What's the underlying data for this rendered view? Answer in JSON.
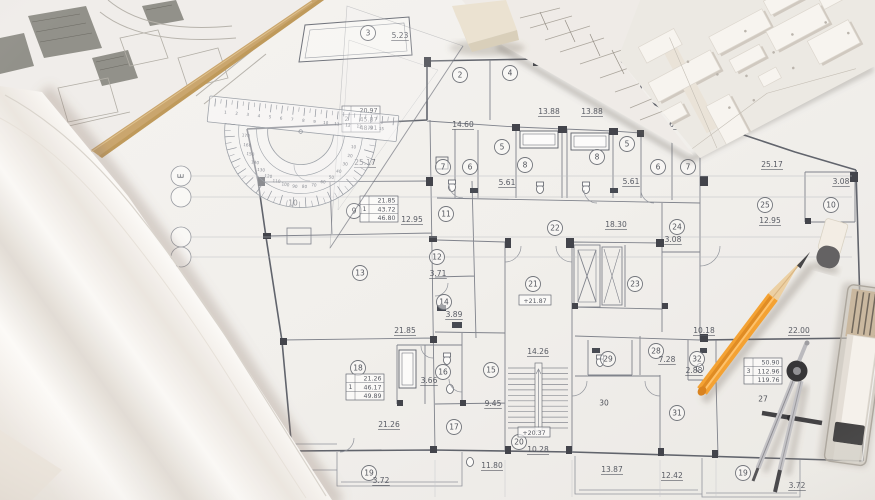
{
  "scene_title": "Architectural blueprint with drafting tools",
  "floor_plan": {
    "grid_bubbles": [
      {
        "label": "E",
        "x": 181,
        "y": 176
      },
      {
        "label": "",
        "x": 181,
        "y": 197
      },
      {
        "label": "",
        "x": 181,
        "y": 237
      },
      {
        "label": "",
        "x": 181,
        "y": 257
      }
    ],
    "rooms": [
      {
        "n": "3",
        "x": 368,
        "y": 33,
        "circled": true
      },
      {
        "n": "2",
        "x": 460,
        "y": 75,
        "circled": true
      },
      {
        "n": "4",
        "x": 510,
        "y": 73,
        "circled": true
      },
      {
        "n": "5",
        "x": 502,
        "y": 147,
        "circled": true
      },
      {
        "n": "7",
        "x": 443,
        "y": 167,
        "circled": true
      },
      {
        "n": "6",
        "x": 470,
        "y": 167,
        "circled": true
      },
      {
        "n": "8",
        "x": 525,
        "y": 165,
        "circled": true
      },
      {
        "n": "8",
        "x": 597,
        "y": 157,
        "circled": true
      },
      {
        "n": "5",
        "x": 627,
        "y": 144,
        "circled": true
      },
      {
        "n": "6",
        "x": 658,
        "y": 167,
        "circled": true
      },
      {
        "n": "7",
        "x": 688,
        "y": 167,
        "circled": true
      },
      {
        "n": "10",
        "x": 293,
        "y": 203,
        "circled": false
      },
      {
        "n": "9",
        "x": 354,
        "y": 211,
        "circled": true
      },
      {
        "n": "11",
        "x": 446,
        "y": 214,
        "circled": true
      },
      {
        "n": "25",
        "x": 765,
        "y": 205,
        "circled": true
      },
      {
        "n": "10",
        "x": 831,
        "y": 205,
        "circled": true
      },
      {
        "n": "24",
        "x": 677,
        "y": 227,
        "circled": true
      },
      {
        "n": "12",
        "x": 437,
        "y": 257,
        "circled": true
      },
      {
        "n": "13",
        "x": 360,
        "y": 273,
        "circled": true
      },
      {
        "n": "22",
        "x": 555,
        "y": 228,
        "circled": true
      },
      {
        "n": "21",
        "x": 533,
        "y": 284,
        "circled": true
      },
      {
        "n": "23",
        "x": 635,
        "y": 284,
        "circled": true
      },
      {
        "n": "14",
        "x": 444,
        "y": 302,
        "circled": true
      },
      {
        "n": "18",
        "x": 358,
        "y": 368,
        "circled": true
      },
      {
        "n": "16",
        "x": 443,
        "y": 372,
        "circled": true
      },
      {
        "n": "15",
        "x": 491,
        "y": 370,
        "circled": true
      },
      {
        "n": "28",
        "x": 656,
        "y": 351,
        "circled": true
      },
      {
        "n": "29",
        "x": 608,
        "y": 359,
        "circled": true
      },
      {
        "n": "32",
        "x": 697,
        "y": 359,
        "circled": true
      },
      {
        "n": "27",
        "x": 763,
        "y": 399,
        "circled": false
      },
      {
        "n": "30",
        "x": 604,
        "y": 403,
        "circled": false
      },
      {
        "n": "31",
        "x": 677,
        "y": 413,
        "circled": true
      },
      {
        "n": "17",
        "x": 454,
        "y": 427,
        "circled": true
      },
      {
        "n": "20",
        "x": 519,
        "y": 442,
        "circled": true
      },
      {
        "n": "19",
        "x": 369,
        "y": 473,
        "circled": true
      },
      {
        "n": "19",
        "x": 743,
        "y": 473,
        "circled": true
      }
    ],
    "dimensions": [
      {
        "t": "5.23",
        "x": 400,
        "y": 38
      },
      {
        "t": "14.60",
        "x": 463,
        "y": 127
      },
      {
        "t": "13.88",
        "x": 549,
        "y": 114
      },
      {
        "t": "13.88",
        "x": 592,
        "y": 114
      },
      {
        "t": "14.62",
        "x": 668,
        "y": 127
      },
      {
        "t": "25.17",
        "x": 365,
        "y": 165
      },
      {
        "t": "25.17",
        "x": 772,
        "y": 167
      },
      {
        "t": "5.61",
        "x": 507,
        "y": 185
      },
      {
        "t": "5.61",
        "x": 631,
        "y": 184
      },
      {
        "t": "3.08",
        "x": 841,
        "y": 184
      },
      {
        "t": "12.95",
        "x": 412,
        "y": 222
      },
      {
        "t": "12.95",
        "x": 770,
        "y": 223
      },
      {
        "t": "18.30",
        "x": 616,
        "y": 227
      },
      {
        "t": "3.71",
        "x": 438,
        "y": 276
      },
      {
        "t": "3.08",
        "x": 673,
        "y": 242
      },
      {
        "t": "3.89",
        "x": 454,
        "y": 317
      },
      {
        "t": "21.85",
        "x": 405,
        "y": 333
      },
      {
        "t": "10.18",
        "x": 704,
        "y": 333
      },
      {
        "t": "22.00",
        "x": 799,
        "y": 333
      },
      {
        "t": "14.26",
        "x": 538,
        "y": 354
      },
      {
        "t": "7.28",
        "x": 667,
        "y": 362
      },
      {
        "t": "2.88",
        "x": 694,
        "y": 373
      },
      {
        "t": "3.66",
        "x": 429,
        "y": 383
      },
      {
        "t": "9.45",
        "x": 493,
        "y": 406
      },
      {
        "t": "21.26",
        "x": 389,
        "y": 427
      },
      {
        "t": "10.28",
        "x": 538,
        "y": 452
      },
      {
        "t": "11.80",
        "x": 492,
        "y": 468
      },
      {
        "t": "13.87",
        "x": 612,
        "y": 472
      },
      {
        "t": "12.42",
        "x": 672,
        "y": 478
      },
      {
        "t": "3.72",
        "x": 381,
        "y": 483
      },
      {
        "t": "3.72",
        "x": 797,
        "y": 488
      }
    ],
    "elevations": [
      {
        "t": "+21.87",
        "x": 535,
        "y": 302
      },
      {
        "t": "+20.37",
        "x": 534,
        "y": 434
      }
    ],
    "tables": [
      {
        "num": "1",
        "rows": [
          "21.85",
          "43.72",
          "46.80"
        ],
        "x": 360,
        "y": 196
      },
      {
        "num": "2",
        "rows": [
          "20.97",
          "45.87",
          "48.91"
        ],
        "x": 342,
        "y": 106
      },
      {
        "num": "1",
        "rows": [
          "21.26",
          "46.17",
          "49.89"
        ],
        "x": 346,
        "y": 374
      },
      {
        "num": "3",
        "rows": [
          "50.90",
          "112.96",
          "119.76"
        ],
        "x": 744,
        "y": 358
      }
    ]
  },
  "protractor": {
    "cm_labels": [
      "1",
      "2",
      "3",
      "4",
      "5",
      "6",
      "7",
      "8",
      "9",
      "10",
      "11",
      "12",
      "13",
      "14",
      "15"
    ],
    "degree_labels": [
      "10",
      "20",
      "30",
      "40",
      "50",
      "60",
      "70",
      "80",
      "90",
      "100",
      "110",
      "120",
      "130",
      "140",
      "150",
      "160",
      "170"
    ]
  },
  "colors": {
    "pencil_orange": "#f5a02c",
    "blueprint_line": "#7b7f89",
    "wood_edge": "#c9a46a",
    "paper": "#f3f2ef"
  }
}
